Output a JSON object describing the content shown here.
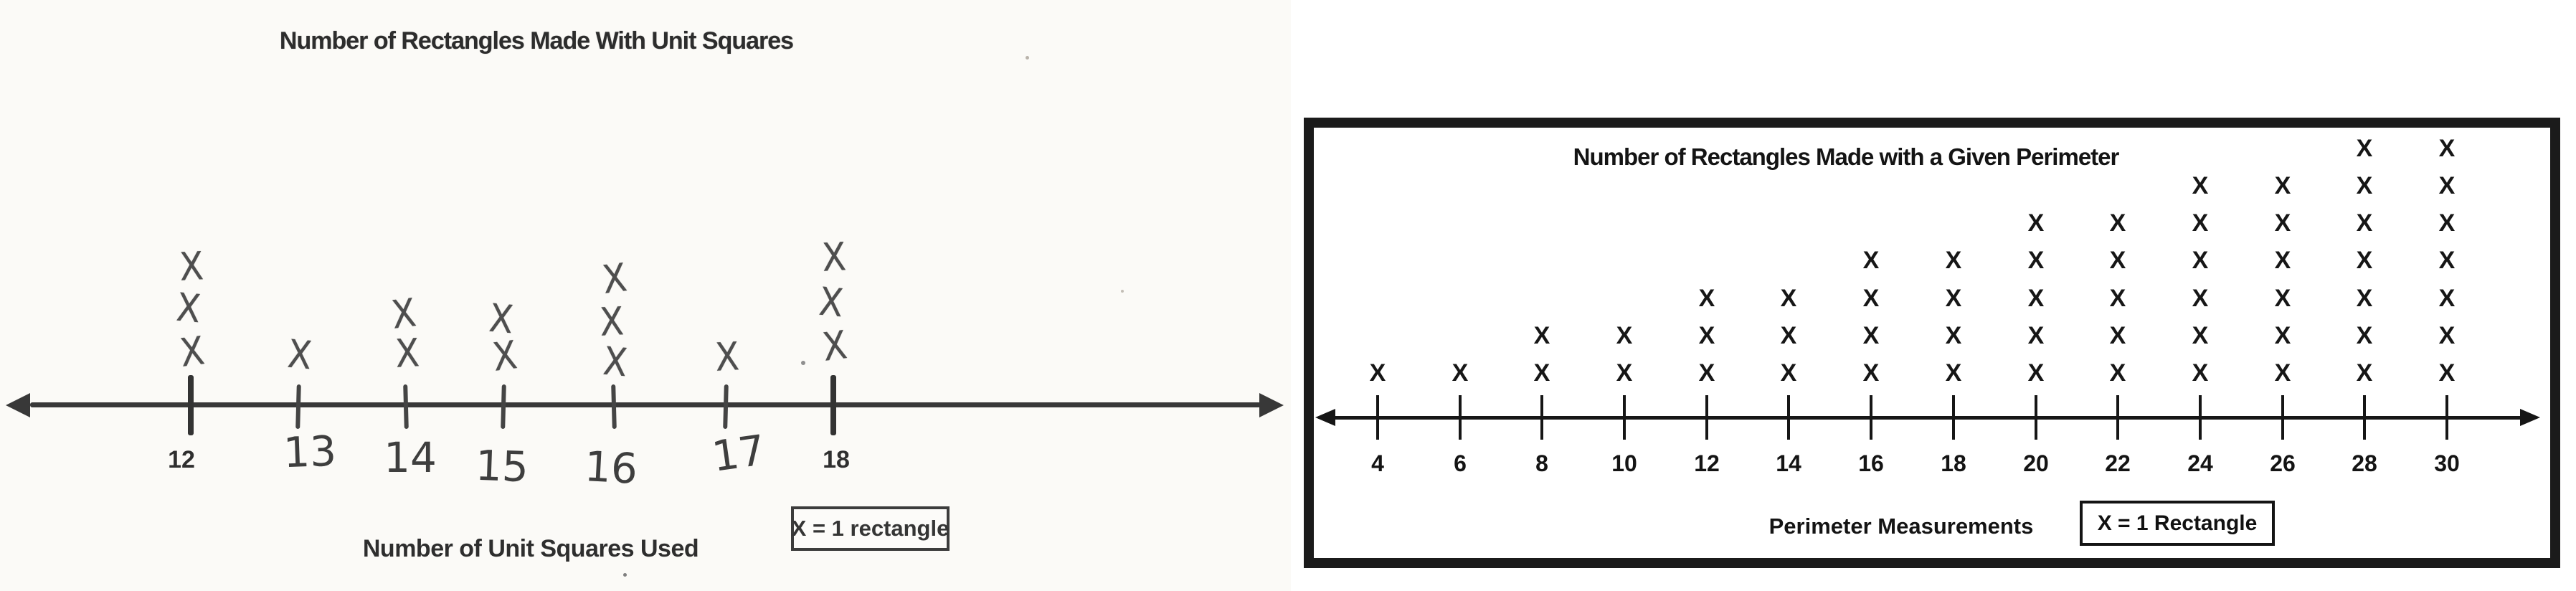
{
  "page": {
    "background": "#ffffff",
    "left_panel_background": "#fbfaf7",
    "ink_left": "#4e4e4e",
    "ink_right": "#161616"
  },
  "chart_data": [
    {
      "id": "unit-squares",
      "type": "line-plot",
      "title": "Number of Rectangles Made With Unit Squares",
      "xlabel": "Number of Unit Squares Used",
      "legend": "X = 1 rectangle",
      "symbol": "X",
      "categories": [
        "12",
        "13",
        "14",
        "15",
        "16",
        "17",
        "18"
      ],
      "values": [
        3,
        1,
        2,
        2,
        3,
        1,
        3
      ],
      "axis_arrows": "both-ends",
      "legend_position": "below-axis-right",
      "style": "hand-drawn pencil on scanned paper, printed title and labels for 12 and 18, handwritten 13-17"
    },
    {
      "id": "perimeter",
      "type": "line-plot",
      "title": "Number of Rectangles Made with a Given Perimeter",
      "xlabel": "Perimeter Measurements",
      "legend": "X = 1 Rectangle",
      "symbol": "X",
      "categories": [
        "4",
        "6",
        "8",
        "10",
        "12",
        "14",
        "16",
        "18",
        "20",
        "22",
        "24",
        "26",
        "28",
        "30"
      ],
      "values": [
        1,
        1,
        2,
        2,
        3,
        3,
        4,
        4,
        5,
        5,
        6,
        6,
        7,
        7
      ],
      "axis_arrows": "both-ends",
      "legend_position": "below-axis-right",
      "frame": true,
      "style": "printed black on white inside thick black border"
    }
  ]
}
